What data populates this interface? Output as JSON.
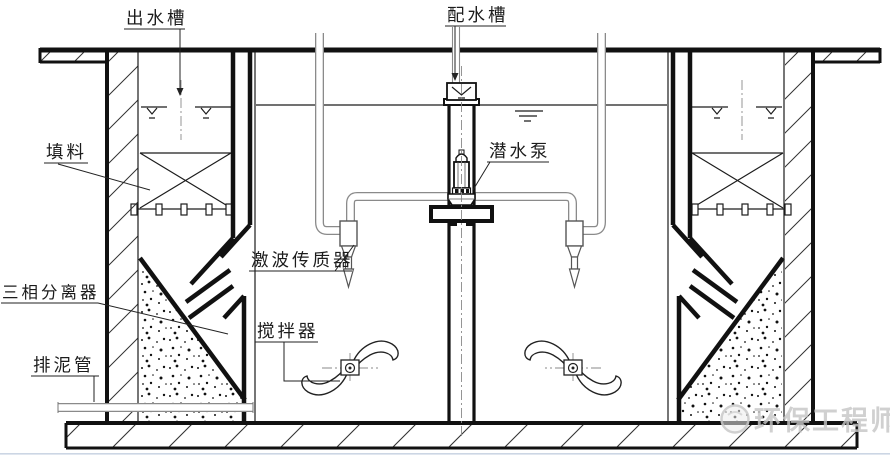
{
  "page": {
    "background": "#ffffff",
    "type": "process-engineering-section-diagram"
  },
  "labels": {
    "outlet_trough": "出水槽",
    "distribution_trough": "配水槽",
    "packing": "填料",
    "submersible_pump": "潜水泵",
    "shock_wave_mass_transfer": "激波传质器",
    "three_phase_separator": "三相分离器",
    "agitator": "搅拌器",
    "sludge_discharge_pipe": "排泥管"
  },
  "watermark": {
    "text": "环保工程师"
  },
  "colors": {
    "line": "#1c1c1c",
    "pipe_outline": "#8a8a8a",
    "watermark_gray": "#c6c6c6",
    "background": "#ffffff"
  }
}
